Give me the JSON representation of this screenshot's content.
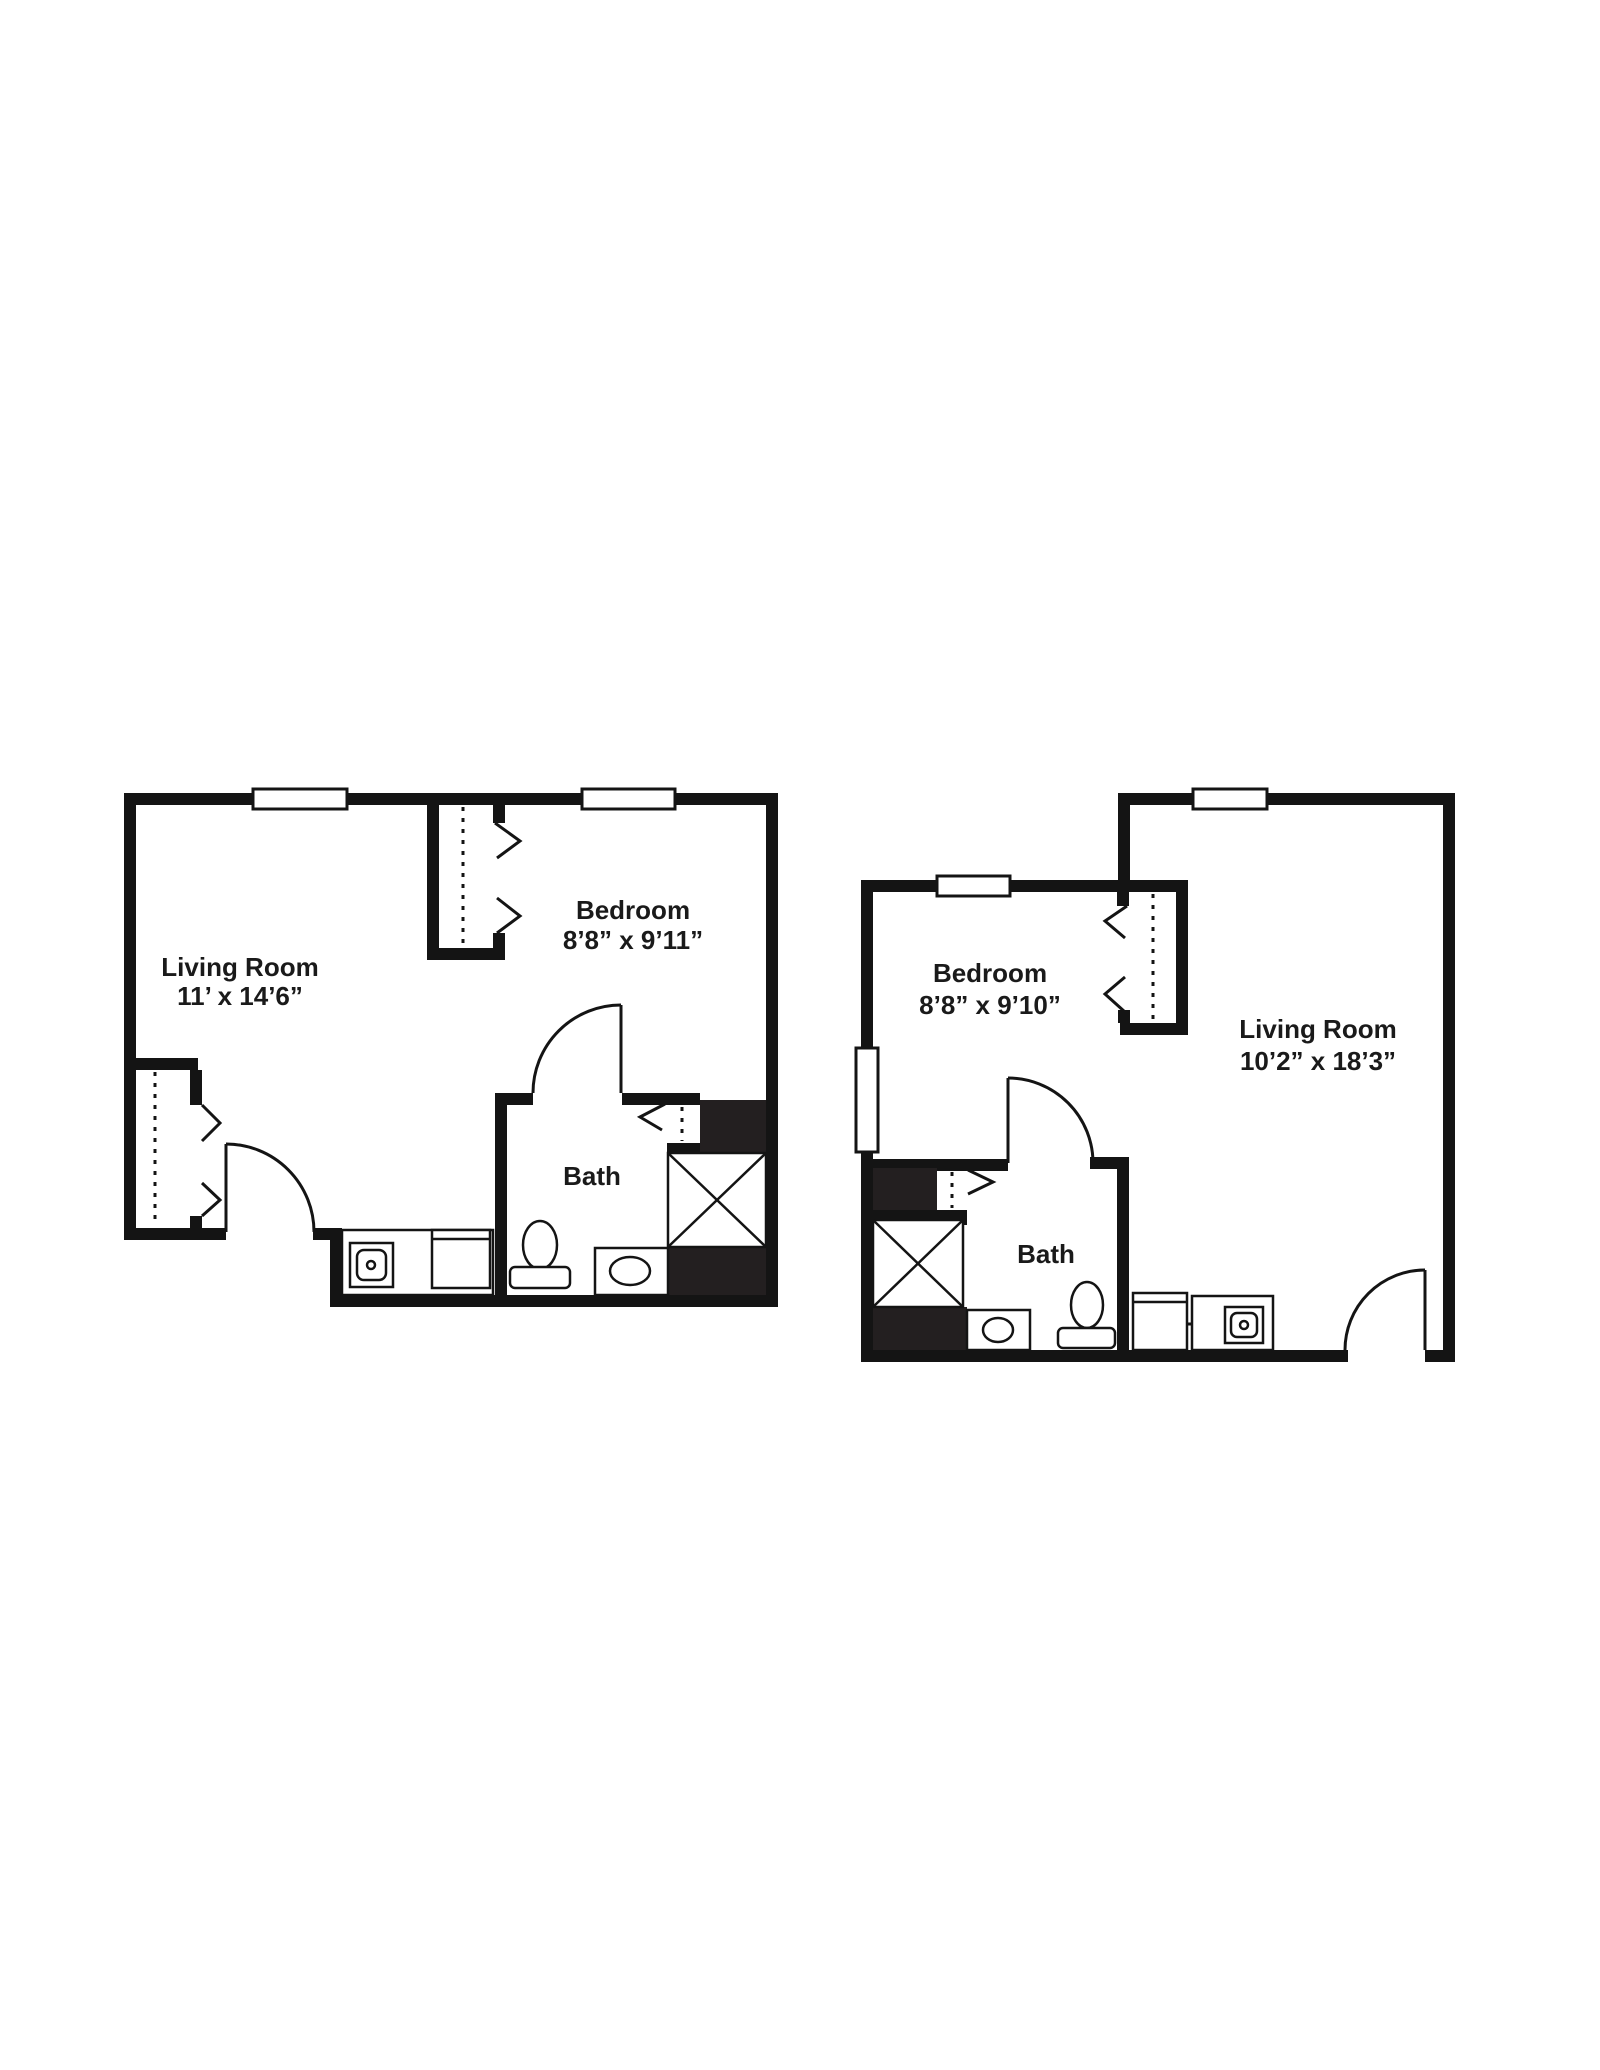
{
  "canvas": {
    "background": "#ffffff",
    "ink": "#141414",
    "text_color": "#1a1a1a"
  },
  "plans": [
    {
      "id": "unit-a",
      "labels": {
        "living_room": {
          "name": "Living Room",
          "dims": "11’ x 14’6”"
        },
        "bedroom": {
          "name": "Bedroom",
          "dims": "8’8” x 9’11”"
        },
        "bath": {
          "name": "Bath"
        }
      }
    },
    {
      "id": "unit-b",
      "labels": {
        "bedroom": {
          "name": "Bedroom",
          "dims": "8’8” x 9’10”"
        },
        "living_room": {
          "name": "Living Room",
          "dims": "10’2” x 18’3”"
        },
        "bath": {
          "name": "Bath"
        }
      }
    }
  ]
}
